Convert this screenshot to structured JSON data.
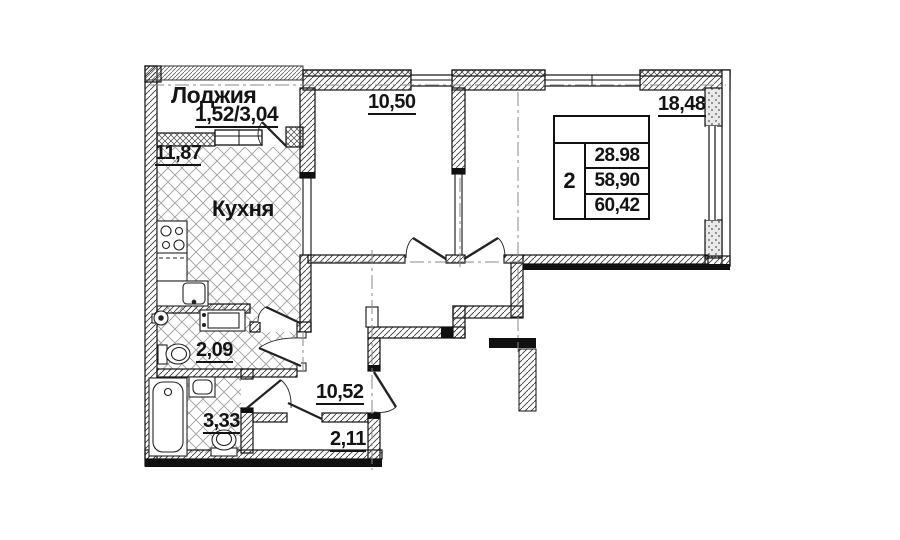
{
  "rooms": {
    "loggia": {
      "name": "Лоджия",
      "area": "1,52/3,04"
    },
    "kitchen": {
      "name": "Кухня",
      "area": "11,87"
    },
    "room_1": {
      "area": "10,50"
    },
    "room_2": {
      "area": "18,48"
    },
    "wc": {
      "area": "2,09"
    },
    "bathroom": {
      "area": "3,33"
    },
    "hallway": {
      "area": "10,52"
    },
    "wardrobe": {
      "area": "2,11"
    }
  },
  "info_table": {
    "rooms_count": "2",
    "living_area": "28.98",
    "area_without_loggia": "58,90",
    "total_area": "60,42"
  },
  "colors": {
    "line": "#111111",
    "text": "#141414",
    "floor_hatch": "#9e9e9e"
  }
}
